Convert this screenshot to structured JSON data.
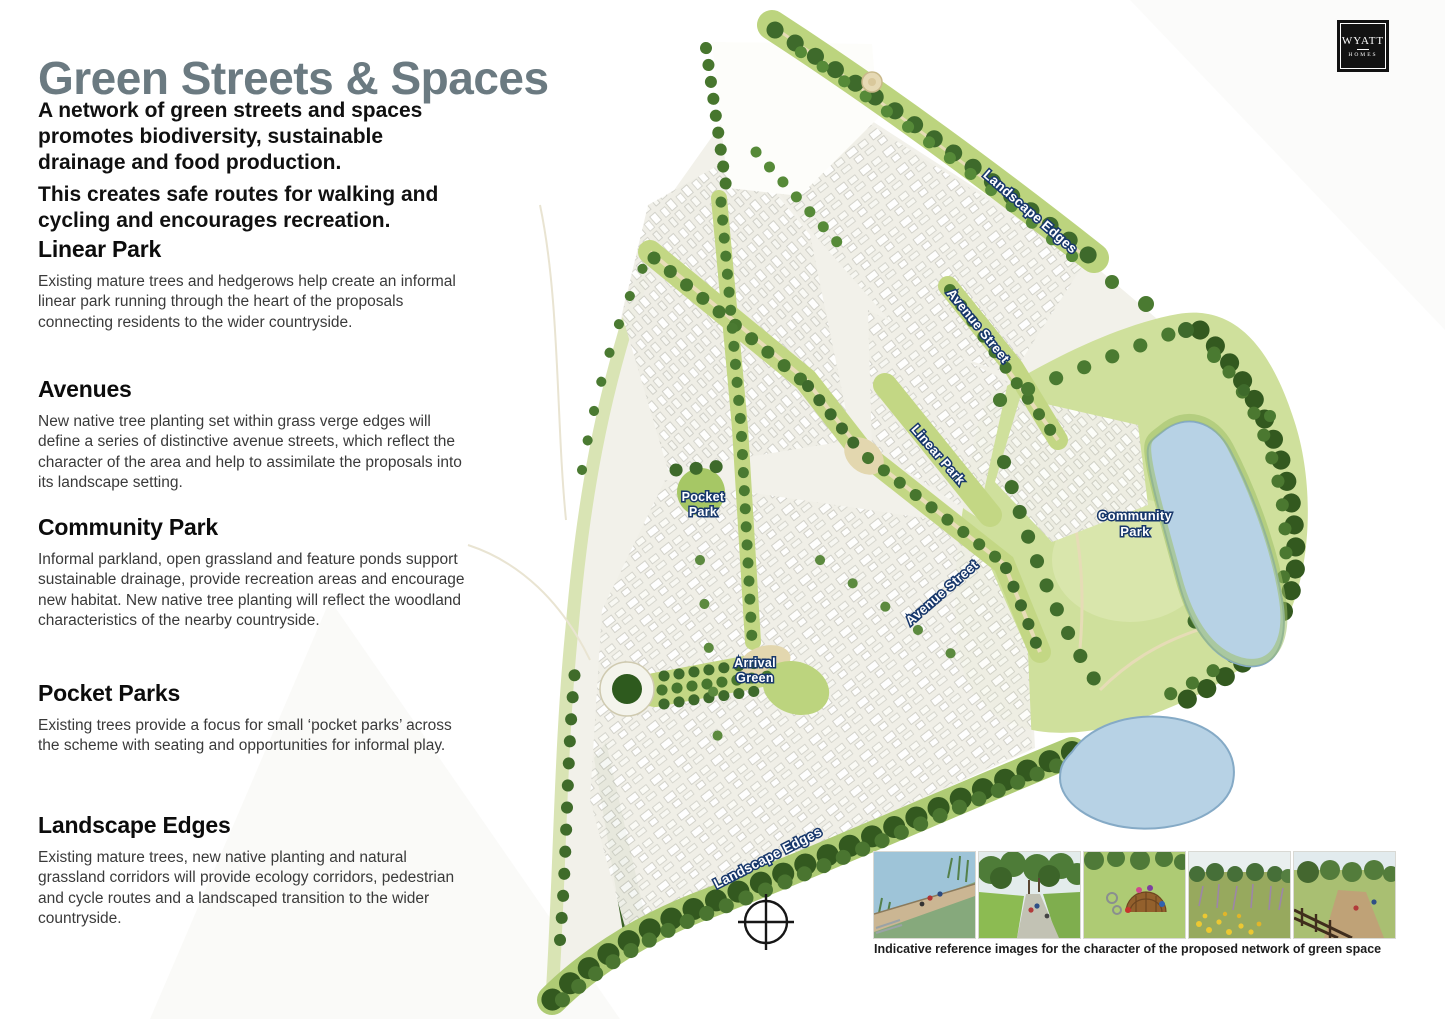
{
  "page": {
    "title": "Green Streets & Spaces",
    "intro_p1": "A network of green streets and spaces promotes biodiversity, sustainable drainage and food production.",
    "intro_p2": "This creates safe routes for walking and cycling and encourages recreation."
  },
  "sections": [
    {
      "heading": "Linear Park",
      "body": "Existing mature trees and hedgerows help create an informal linear park running through the heart of the proposals connecting residents to the wider countryside."
    },
    {
      "heading": "Avenues",
      "body": "New native tree planting set within grass verge edges will define a series of distinctive avenue streets, which reflect the character of the area and help to assimilate the proposals into its landscape setting."
    },
    {
      "heading": "Community Park",
      "body": "Informal parkland, open grassland and feature ponds support sustainable drainage, provide recreation areas and encourage new habitat. New native tree planting will reflect the woodland characteristics of the nearby countryside."
    },
    {
      "heading": "Pocket Parks",
      "body": "Existing trees provide a focus for small ‘pocket parks’ across the scheme with seating and opportunities for informal play."
    },
    {
      "heading": "Landscape Edges",
      "body": "Existing mature trees, new native planting and natural grassland corridors will provide ecology corridors, pedestrian and cycle routes and a landscaped transition to the wider countryside."
    }
  ],
  "logo": {
    "name": "WYATT",
    "sub": "HOMES"
  },
  "map": {
    "labels": {
      "landscape_edges_top": "Landscape Edges",
      "avenue_street_1": "Avenue Street",
      "linear_park": "Linear Park",
      "pocket_park_line1": "Pocket",
      "pocket_park_line2": "Park",
      "community_park_line1": "Community",
      "community_park_line2": "Park",
      "avenue_street_2": "Avenue Street",
      "arrival_green_line1": "Arrival",
      "arrival_green_line2": "Green",
      "landscape_edges_bottom": "Landscape Edges"
    }
  },
  "caption": "Indicative reference images for the character of the proposed network of green space",
  "palette": {
    "title_color": "#6b7a81",
    "heading_color": "#0c0c0c",
    "body_color": "#3a3a3a",
    "label_fill": "#ffffff",
    "label_outline": "#17376b",
    "tree_dark": "#33591f",
    "tree_mid": "#47762e",
    "grass_light": "#c3d784",
    "park_grass": "#cfe09c",
    "housing": "#f0efe7",
    "road_beige": "#e3d7af",
    "pond_blue": "#b7d2e5"
  }
}
